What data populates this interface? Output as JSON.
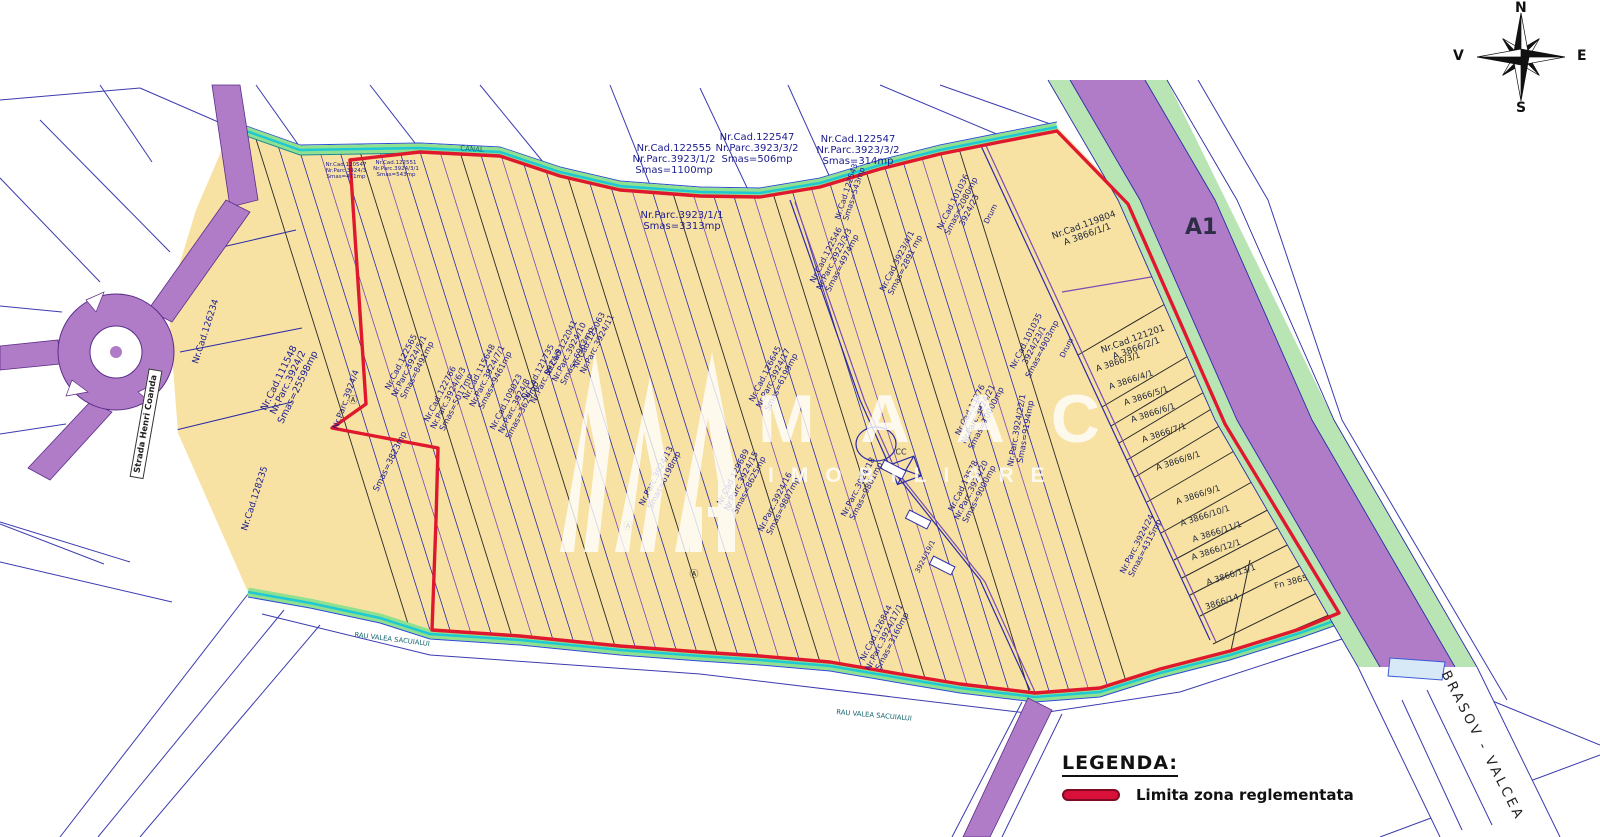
{
  "title": "Plan cadastral - zona reglementata",
  "compass": {
    "north": "N",
    "south": "S",
    "east": "E",
    "west": "V"
  },
  "legend": {
    "title": "LEGENDA:",
    "items": [
      {
        "label": "Limita zona reglementata",
        "color": "#d8103a"
      }
    ]
  },
  "watermark": {
    "brand": "MAAC",
    "subtitle": "IMOBILIARE"
  },
  "roads": {
    "highway_label": "A1",
    "route_label": "BRASOV - VALCEA",
    "street_label": "Strada Henri Coanda"
  },
  "colors": {
    "zone_fill": "#f8e2a3",
    "boundary_red": "#e0182d",
    "highway_purple": "#b07cc8",
    "highway_green_strip": "#b9e4b4",
    "canal_green": "#8fe08f",
    "canal_cyan": "#1fc9d4",
    "parcel_line_navy": "#2b2ba6"
  },
  "parcel_labels": [
    {
      "x": 674,
      "y": 160,
      "rot": 0,
      "size": 10,
      "lines": [
        "Nr.Cad.122555",
        "Nr.Parc.3923/1/2",
        "Smas=1100mp"
      ]
    },
    {
      "x": 757,
      "y": 149,
      "rot": 0,
      "size": 10,
      "lines": [
        "Nr.Cad.122547",
        "Nr.Parc.3923/3/2",
        "Smas=506mp"
      ]
    },
    {
      "x": 858,
      "y": 151,
      "rot": 0,
      "size": 10,
      "lines": [
        "Nr.Cad.122547",
        "Nr.Parc.3923/3/2",
        "Smas=314mp"
      ]
    },
    {
      "x": 682,
      "y": 222,
      "rot": 0,
      "size": 10,
      "lines": [
        "Nr.Parc.3923/1/1",
        "Smas=3313mp"
      ]
    },
    {
      "x": 207,
      "y": 332,
      "rot": -72,
      "size": 9,
      "lines": [
        "Nr.Cad.126234"
      ]
    },
    {
      "x": 289,
      "y": 383,
      "rot": -64,
      "size": 9.5,
      "lines": [
        "Nr.Cad.111548",
        "Nr.Parc.3924/2",
        "Smas=25598mp"
      ]
    },
    {
      "x": 256,
      "y": 499,
      "rot": -72,
      "size": 9,
      "lines": [
        "Nr.Cad.128235"
      ]
    },
    {
      "x": 347,
      "y": 400,
      "rot": -70,
      "size": 8.5,
      "lines": [
        "Nr.Parc.3924/4"
      ]
    },
    {
      "x": 391,
      "y": 462,
      "rot": -64,
      "size": 8.5,
      "lines": [
        "Smas=3823mp"
      ]
    },
    {
      "x": 409,
      "y": 366,
      "rot": -63,
      "size": 8.2,
      "lines": [
        "Nr.Cad.122565",
        "Nr.Parc.3924/5/1",
        "Smas=8491mp"
      ]
    },
    {
      "x": 448,
      "y": 398,
      "rot": -63,
      "size": 8.2,
      "lines": [
        "Nr.Cad.122766",
        "Nr.Parc.3924/6/3",
        "Smas=5017mp"
      ]
    },
    {
      "x": 487,
      "y": 376,
      "rot": -63,
      "size": 8.2,
      "lines": [
        "Nr.Cad.115648",
        "Nr.Parc.3924/7/1",
        "Smas=9461mp"
      ]
    },
    {
      "x": 514,
      "y": 406,
      "rot": -63,
      "size": 8.2,
      "lines": [
        "Nr.Cad.109023",
        "Nr.Parc.3924/8",
        "Smas=3629mp"
      ]
    },
    {
      "x": 542,
      "y": 374,
      "rot": -63,
      "size": 8.2,
      "lines": [
        "Nr.Cad.121735",
        "Nr.Parc.3924/9"
      ]
    },
    {
      "x": 569,
      "y": 352,
      "rot": -63,
      "size": 8.2,
      "lines": [
        "Nr.Cad.122041",
        "Nr.Parc.3924/10",
        "Smas=6963mp"
      ]
    },
    {
      "x": 593,
      "y": 342,
      "rot": -63,
      "size": 8.2,
      "lines": [
        "Nr.Cad.125063",
        "Nr.Parc.3924/11"
      ]
    },
    {
      "x": 660,
      "y": 478,
      "rot": -63,
      "size": 8.2,
      "lines": [
        "Nr.Parc.3924/13",
        "Smas=6198mp"
      ]
    },
    {
      "x": 773,
      "y": 378,
      "rot": -63,
      "size": 8.2,
      "lines": [
        "Nr.Cad.126645",
        "Nr.Parc.3924/17",
        "Smas=6199mp"
      ]
    },
    {
      "x": 741,
      "y": 481,
      "rot": -63,
      "size": 8.2,
      "lines": [
        "Nr.Cad.129689",
        "Nr.Parc.3924/15",
        "Smas=8625mp"
      ]
    },
    {
      "x": 779,
      "y": 504,
      "rot": -63,
      "size": 8.2,
      "lines": [
        "Nr.Parc.3924/16",
        "Smas=9807mp"
      ]
    },
    {
      "x": 884,
      "y": 637,
      "rot": -63,
      "size": 8.2,
      "lines": [
        "Nr.Cad.126844",
        "Nr.Parc.3924/17/1",
        "Smas=3160mp"
      ]
    },
    {
      "x": 862,
      "y": 489,
      "rot": -63,
      "size": 8.2,
      "lines": [
        "Nr.Parc.3924/18",
        "Smas=9801mp"
      ]
    },
    {
      "x": 978,
      "y": 414,
      "rot": -63,
      "size": 8.2,
      "lines": [
        "Nr.Cad.13576",
        "Nr.Parc.3924/21",
        "Smas=10000mp"
      ]
    },
    {
      "x": 971,
      "y": 490,
      "rot": -63,
      "size": 8.2,
      "lines": [
        "Nr.Cad.13578",
        "Nr.Parc.3924/20",
        "Smas=9000mp"
      ]
    },
    {
      "x": 1034,
      "y": 345,
      "rot": -63,
      "size": 8.2,
      "lines": [
        "Nr.Cad.101035",
        "3924/23/1",
        "Smas=4903mp"
      ]
    },
    {
      "x": 961,
      "y": 206,
      "rot": -63,
      "size": 8.2,
      "lines": [
        "Nr.Cad.101036",
        "Smas=2080mp",
        "3924/23"
      ]
    },
    {
      "x": 834,
      "y": 259,
      "rot": -63,
      "size": 8.2,
      "lines": [
        "Nr.Cad.122546",
        "Nr.Parc.3923/3/3",
        "Smas=4974mp"
      ]
    },
    {
      "x": 901,
      "y": 263,
      "rot": -63,
      "size": 8.2,
      "lines": [
        "Nr.Cad.3923/4/1",
        "Smas=2891 mp"
      ]
    },
    {
      "x": 851,
      "y": 193,
      "rot": -72,
      "size": 7.8,
      "lines": [
        "Nr.Cad.122543",
        "Smas=543mp"
      ]
    },
    {
      "x": 1021,
      "y": 431,
      "rot": -80,
      "size": 8.2,
      "lines": [
        "Nr.Parc.3924/22/1",
        "Smas=9194mp"
      ]
    },
    {
      "x": 1086,
      "y": 231,
      "rot": -20,
      "size": 9,
      "color": "#222a3c",
      "lines": [
        "Nr.Cad.119804",
        "A 3866/1/1"
      ]
    },
    {
      "x": 1135,
      "y": 345,
      "rot": -20,
      "size": 9,
      "color": "#222a3c",
      "lines": [
        "Nr.Cad.121201",
        "A 3866/2/1"
      ]
    },
    {
      "x": 1118,
      "y": 362,
      "rot": -18,
      "size": 8.4,
      "color": "#222a3c",
      "lines": [
        "A 3866/3/1"
      ]
    },
    {
      "x": 1131,
      "y": 380,
      "rot": -18,
      "size": 8.4,
      "color": "#222a3c",
      "lines": [
        "A 3866/4/1"
      ]
    },
    {
      "x": 1146,
      "y": 396,
      "rot": -18,
      "size": 8.4,
      "color": "#222a3c",
      "lines": [
        "A 3866/5/1"
      ]
    },
    {
      "x": 1153,
      "y": 413,
      "rot": -18,
      "size": 8.4,
      "color": "#222a3c",
      "lines": [
        "A 3866/6/1"
      ]
    },
    {
      "x": 1164,
      "y": 433,
      "rot": -18,
      "size": 8.4,
      "color": "#222a3c",
      "lines": [
        "A 3866/7/1"
      ]
    },
    {
      "x": 1178,
      "y": 461,
      "rot": -18,
      "size": 8.4,
      "color": "#222a3c",
      "lines": [
        "A 3866/8/1"
      ]
    },
    {
      "x": 1198,
      "y": 495,
      "rot": -18,
      "size": 8.4,
      "color": "#222a3c",
      "lines": [
        "A 3866/9/1"
      ]
    },
    {
      "x": 1205,
      "y": 516,
      "rot": -18,
      "size": 8.4,
      "color": "#222a3c",
      "lines": [
        "A 3866/10/1"
      ]
    },
    {
      "x": 1217,
      "y": 532,
      "rot": -18,
      "size": 8.4,
      "color": "#222a3c",
      "lines": [
        "A 3866/11/1"
      ]
    },
    {
      "x": 1216,
      "y": 550,
      "rot": -18,
      "size": 8.4,
      "color": "#222a3c",
      "lines": [
        "A 3866/12/1"
      ]
    },
    {
      "x": 1231,
      "y": 575,
      "rot": -18,
      "size": 8.4,
      "color": "#222a3c",
      "lines": [
        "A 3866/13/1"
      ]
    },
    {
      "x": 1222,
      "y": 602,
      "rot": -18,
      "size": 8.4,
      "color": "#222a3c",
      "lines": [
        "3866/14"
      ]
    },
    {
      "x": 1291,
      "y": 582,
      "rot": -15,
      "size": 8.4,
      "color": "#222a3c",
      "lines": [
        "Fn 3865"
      ]
    },
    {
      "x": 1141,
      "y": 546,
      "rot": -63,
      "size": 8.2,
      "lines": [
        "Nr.Parc.3924/24",
        "Smas=4315mp"
      ]
    },
    {
      "x": 901,
      "y": 453,
      "rot": 0,
      "size": 8,
      "color": "#222a3c",
      "name": "construction-label",
      "lines": [
        "CC"
      ]
    },
    {
      "x": 991,
      "y": 214,
      "rot": -63,
      "size": 7.5,
      "name": "road-label",
      "lines": [
        "Drum"
      ]
    },
    {
      "x": 1067,
      "y": 348,
      "rot": -63,
      "size": 7.5,
      "name": "road-label",
      "lines": [
        "Drum"
      ]
    },
    {
      "x": 926,
      "y": 557,
      "rot": -63,
      "size": 7,
      "lines": [
        "3924/19/1"
      ]
    },
    {
      "x": 346,
      "y": 172,
      "rot": 0,
      "size": 5.5,
      "lines": [
        "Nr.Cad.120547",
        "Nr.Parc.3924/3",
        "Smas=471mp"
      ]
    },
    {
      "x": 396,
      "y": 170,
      "rot": 0,
      "size": 5.5,
      "lines": [
        "Nr.Cad.122551",
        "Nr.Parc.3924/3/1",
        "Smas=543mp"
      ]
    },
    {
      "x": 472,
      "y": 150,
      "rot": 4,
      "size": 7,
      "color": "#14656d",
      "name": "canal-label",
      "lines": [
        "CANAL"
      ]
    },
    {
      "x": 392,
      "y": 640,
      "rot": 7,
      "size": 6.8,
      "color": "#14656d",
      "name": "river-label",
      "lines": [
        "RAU VALEA SACUIALUI"
      ]
    },
    {
      "x": 874,
      "y": 716,
      "rot": 5,
      "size": 6.8,
      "color": "#14656d",
      "name": "river-label",
      "lines": [
        "RAU VALEA SACUIALUI"
      ]
    },
    {
      "x": 353,
      "y": 402,
      "rot": 0,
      "size": 9,
      "color": "#222",
      "name": "symbol-marker",
      "lines": [
        "Ⓐ"
      ]
    },
    {
      "x": 628,
      "y": 528,
      "rot": 0,
      "size": 9,
      "color": "#222",
      "name": "symbol-marker",
      "lines": [
        "Ⓐ"
      ]
    },
    {
      "x": 694,
      "y": 576,
      "rot": 0,
      "size": 9,
      "color": "#222",
      "name": "symbol-marker",
      "lines": [
        "Ⓐ"
      ]
    }
  ]
}
